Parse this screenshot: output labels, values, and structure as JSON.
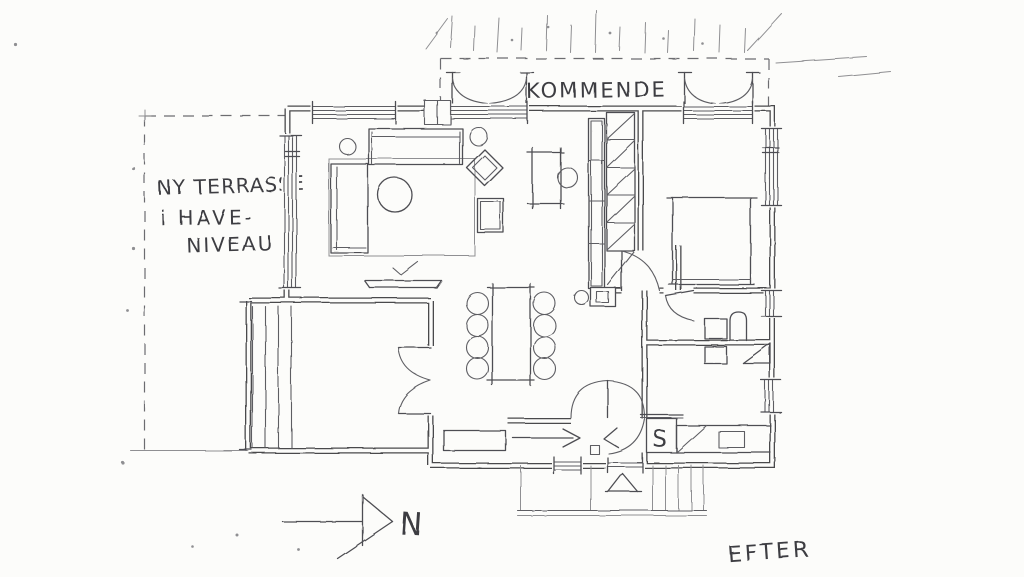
{
  "canvas": {
    "width": 1024,
    "height": 577,
    "paper_color": "#fcfcfa",
    "ink_color": "#48484c",
    "pencil_color": "#8f8f92"
  },
  "annotations": {
    "terrace_label_line1": "NY TERRASSE",
    "terrace_label_line2": "i HAVE-",
    "terrace_label_line3": "NIVEAU",
    "future_balcony_label": "KOMMENDE",
    "north_label": "N",
    "closet_label": "S",
    "caption": "EFTER"
  },
  "features": [
    "hand-drawn floor plan sketch",
    "dashed outline of new garden-level terrace at left",
    "dashed outline of future balcony at top with two double french doors",
    "living room: sofa, daybed, round coffee table, lounge chair, side tables, rug, fireplace",
    "desk with chair",
    "tall shelf unit and ladder stair column",
    "dining table with eight chairs",
    "wood stove",
    "bedroom with double bed",
    "bathroom with toilet, washbasin and corner shower",
    "hall with entry arrow, bench and closet marked S",
    "lower-left room with double doors and side steps",
    "entry porch with outdoor stair",
    "north arrow pointing right"
  ]
}
